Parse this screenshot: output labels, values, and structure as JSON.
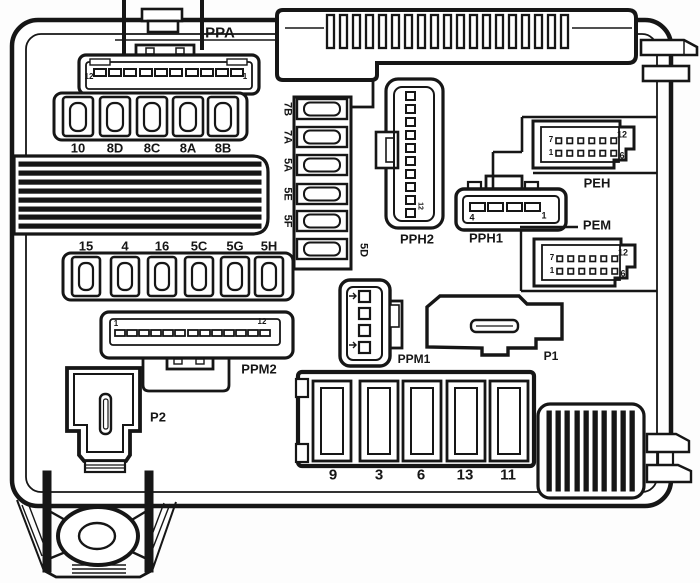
{
  "connector_labels": {
    "ppa": "PPA",
    "pph2": "PPH2",
    "pph1": "PPH1",
    "peh": "PEH",
    "pem": "PEM",
    "ppm2": "PPM2",
    "ppm1": "PPM1",
    "p1": "P1",
    "p2": "P2"
  },
  "fuse_labels": {
    "top_row": [
      "10",
      "8D",
      "8C",
      "8A",
      "8B"
    ],
    "middle_row": [
      "15",
      "4",
      "16",
      "5C",
      "5G",
      "5H"
    ],
    "side_column": [
      "7B",
      "7A",
      "5A",
      "5E",
      "5F"
    ],
    "side_column_right": "5D",
    "bottom_row": [
      "9",
      "3",
      "6",
      "13",
      "11"
    ]
  },
  "pin_numbers": {
    "ppa": {
      "left": "12",
      "right": "1"
    },
    "ppm2": {
      "left": "1",
      "right": "12"
    },
    "pph1": {
      "left": "4",
      "right": "1"
    },
    "pph2": {
      "bottom": "12"
    },
    "peh": {
      "top_left": "7",
      "top_right": "12",
      "bottom_left": "1",
      "bottom_right": "6"
    },
    "pem": {
      "top_left": "7",
      "top_right": "12",
      "bottom_left": "1",
      "bottom_right": "6"
    }
  },
  "colors": {
    "line": "#161616",
    "background": "#ffffff"
  }
}
